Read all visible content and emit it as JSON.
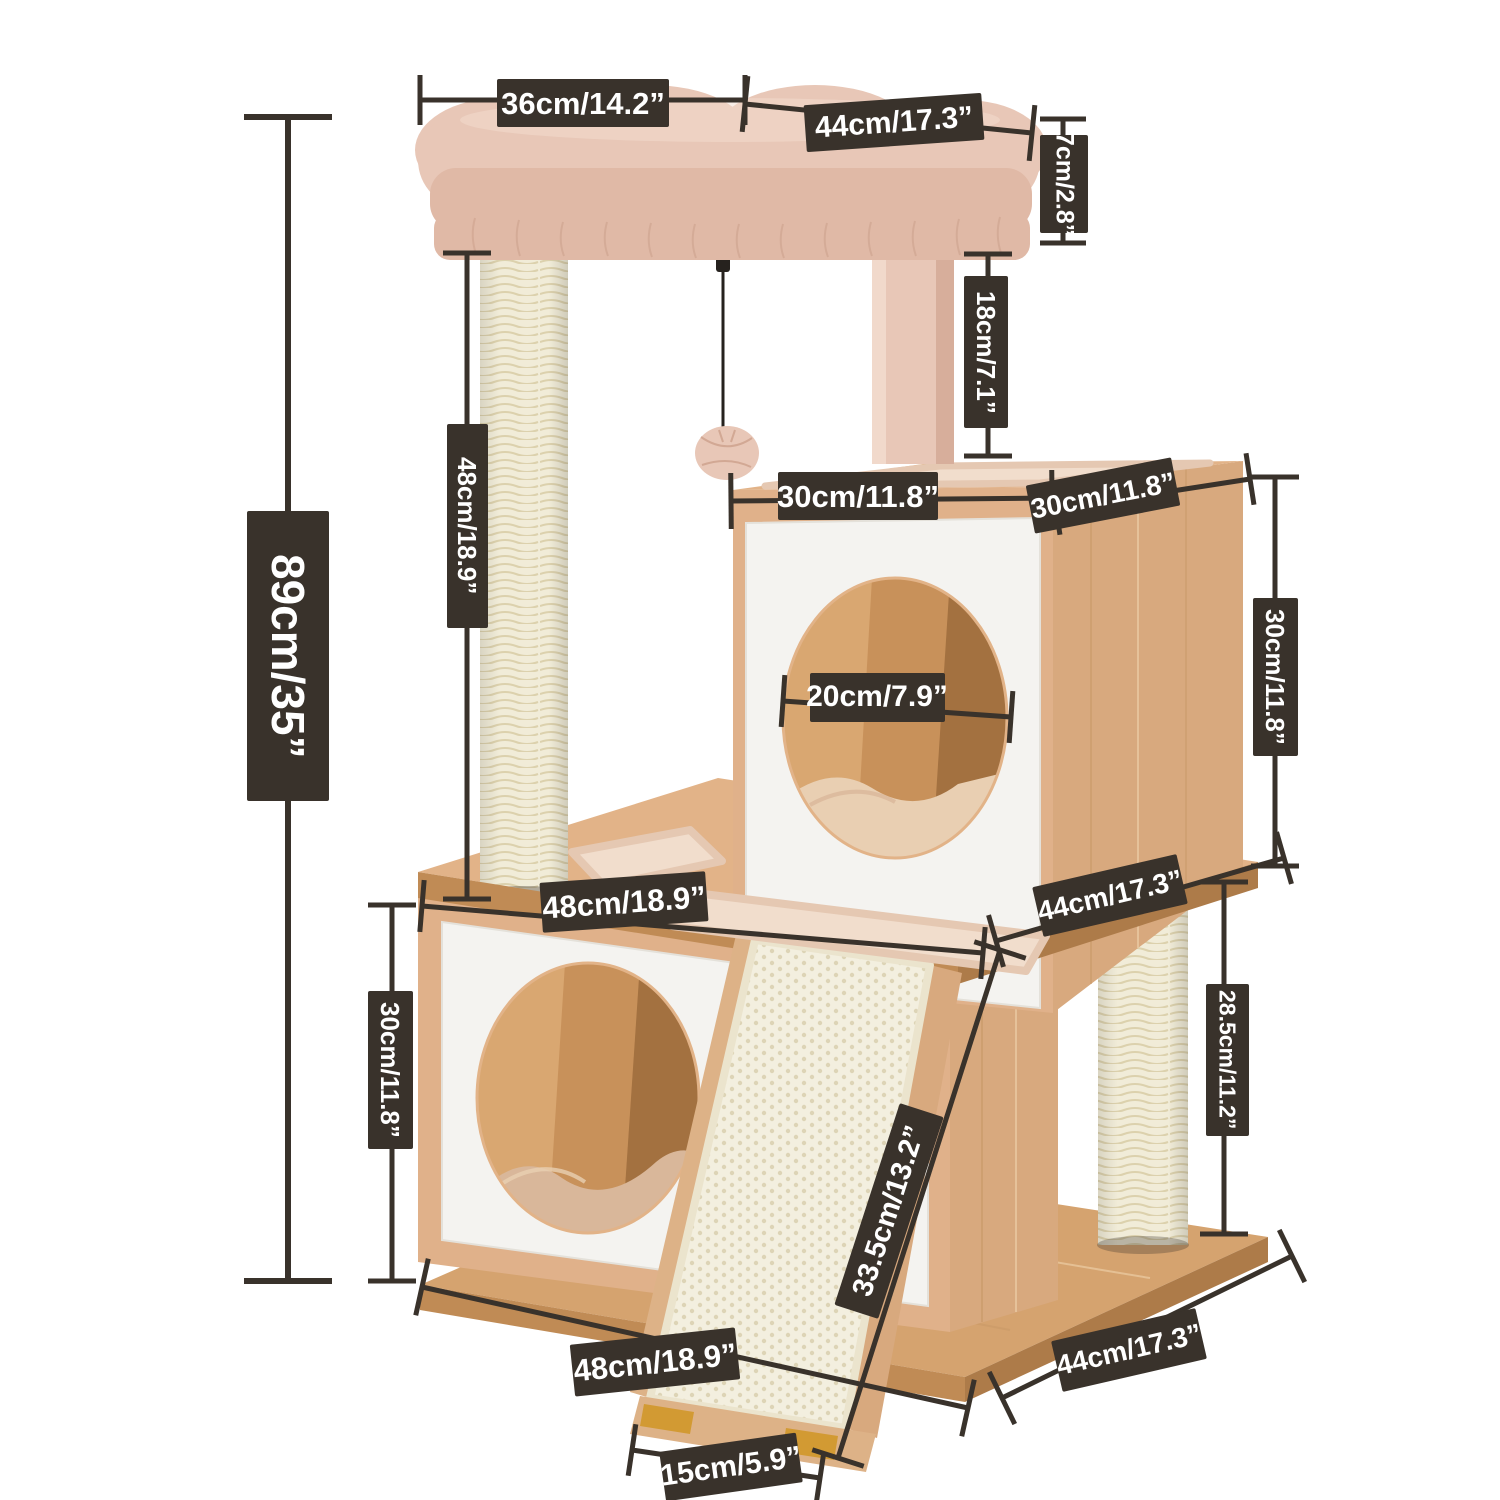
{
  "figure": {
    "background": "#ffffff",
    "kind": "product-dimension-diagram",
    "subject": "cat tree tower with two cube houses, top plush bed, scratching posts and sisal ramp"
  },
  "colors": {
    "bg": "#ffffff",
    "label_bg": "#39322b",
    "label_text": "#ffffff",
    "dim_line": "#39322b",
    "wood_top": "#e2b388",
    "wood_front": "#e0b18a",
    "wood_side": "#d8a97e",
    "wood_grain_dark": "#c69663",
    "wood_grain_light": "#f0d3ad",
    "wood_edge_dark": "#c08b55",
    "wood_edge_darker": "#ad7b49",
    "base_top": "#d5a36f",
    "panel": "#f4f3f0",
    "panel_edge": "#e4e1da",
    "sisal": "#f1ecd8",
    "sisal_stripe": "#dcd1ad",
    "plush": "#e8c7b7",
    "plush_dark": "#e0b9a6",
    "plush_deep": "#d2a894",
    "plush_light": "#f3ddcf",
    "mat": "#f1ddcc",
    "mat_edge": "#e5c8b2",
    "hole_wood": "#c8915a",
    "hole_wood_light": "#d9a771",
    "hole_wood_dark": "#a37140",
    "cushion": "#e9cfb2",
    "cushion_dark": "#d9b79a",
    "ramp_wood": "#ddb287",
    "ramp_sisal": "#f3efdf",
    "ramp_dot": "#ddd4b6",
    "ramp_edge": "#ebe4cd",
    "foot": "#d29a33",
    "string": "#26221e"
  },
  "dimension_labels": [
    {
      "id": "bed-front-width",
      "text": "36cm/14.2”",
      "x": 583,
      "y": 103,
      "w": 172,
      "h": 48,
      "rot": 0,
      "mode": "h",
      "fs": 31
    },
    {
      "id": "bed-side-depth",
      "text": "44cm/17.3”",
      "x": 894,
      "y": 122,
      "w": 178,
      "h": 47,
      "rot": -4,
      "mode": "h",
      "fs": 30
    },
    {
      "id": "bed-thickness",
      "text": "7cm/2.8”",
      "x": 1064,
      "y": 184,
      "w": 48,
      "h": 98,
      "rot": 0,
      "mode": "v",
      "fs": 25
    },
    {
      "id": "bed-to-cube-gap",
      "text": "18cm/7.1”",
      "x": 986,
      "y": 352,
      "w": 44,
      "h": 152,
      "rot": 0,
      "mode": "v",
      "fs": 26
    },
    {
      "id": "total-height",
      "text": "89cm/35”",
      "x": 288,
      "y": 656,
      "w": 82,
      "h": 290,
      "rot": 0,
      "mode": "v",
      "fs": 46
    },
    {
      "id": "top-post-height",
      "text": "48cm/18.9”",
      "x": 467,
      "y": 526,
      "w": 41,
      "h": 204,
      "rot": 0,
      "mode": "v",
      "fs": 26
    },
    {
      "id": "top-cube-width",
      "text": "30cm/11.8”",
      "x": 858,
      "y": 496,
      "w": 160,
      "h": 48,
      "rot": 0,
      "mode": "h",
      "fs": 31
    },
    {
      "id": "top-cube-depth",
      "text": "30cm/11.8”",
      "x": 1103,
      "y": 495,
      "w": 148,
      "h": 49,
      "rot": -11,
      "mode": "h",
      "fs": 28
    },
    {
      "id": "top-cube-height",
      "text": "30cm/11.8”",
      "x": 1275,
      "y": 677,
      "w": 45,
      "h": 158,
      "rot": 0,
      "mode": "v",
      "fs": 26
    },
    {
      "id": "hole-diameter",
      "text": "20cm/7.9”",
      "x": 877,
      "y": 697,
      "w": 135,
      "h": 49,
      "rot": 0,
      "mode": "h",
      "fs": 30
    },
    {
      "id": "middle-platform-depth",
      "text": "44cm/17.3”",
      "x": 1110,
      "y": 895,
      "w": 148,
      "h": 51,
      "rot": -13,
      "mode": "h",
      "fs": 28
    },
    {
      "id": "middle-platform-width",
      "text": "48cm/18.9”",
      "x": 624,
      "y": 902,
      "w": 166,
      "h": 50,
      "rot": -4,
      "mode": "h",
      "fs": 31
    },
    {
      "id": "bottom-cube-height",
      "text": "30cm/11.8”",
      "x": 390,
      "y": 1070,
      "w": 45,
      "h": 158,
      "rot": 0,
      "mode": "v",
      "fs": 26
    },
    {
      "id": "ramp-length",
      "text": "33.5cm/13.2”",
      "x": 889,
      "y": 1211,
      "w": 212,
      "h": 46,
      "rot": -72,
      "mode": "h",
      "fs": 29
    },
    {
      "id": "bottom-post-height",
      "text": "28.5cm/11.2”",
      "x": 1227,
      "y": 1060,
      "w": 43,
      "h": 152,
      "rot": 0,
      "mode": "v",
      "fs": 23
    },
    {
      "id": "base-width",
      "text": "48cm/18.9”",
      "x": 655,
      "y": 1362,
      "w": 166,
      "h": 52,
      "rot": -6,
      "mode": "h",
      "fs": 31
    },
    {
      "id": "base-depth",
      "text": "44cm/17.3”",
      "x": 1129,
      "y": 1350,
      "w": 148,
      "h": 52,
      "rot": -13,
      "mode": "h",
      "fs": 28
    },
    {
      "id": "ramp-foot-width",
      "text": "15cm/5.9”",
      "x": 731,
      "y": 1467,
      "w": 138,
      "h": 50,
      "rot": -8,
      "mode": "h",
      "fs": 30
    }
  ],
  "dimension_lines": [
    {
      "id": "bed-front-width",
      "x1": 420,
      "y1": 100,
      "x2": 745,
      "y2": 100,
      "t": 50
    },
    {
      "id": "bed-side-depth",
      "x1": 745,
      "y1": 104,
      "x2": 1032,
      "y2": 133,
      "t": 56
    },
    {
      "id": "bed-thickness",
      "x1": 1063,
      "y1": 119,
      "x2": 1063,
      "y2": 243,
      "t": 46
    },
    {
      "id": "bed-to-cube-gap",
      "x1": 988,
      "y1": 254,
      "x2": 988,
      "y2": 456,
      "t": 48
    },
    {
      "id": "total-height",
      "x1": 288,
      "y1": 117,
      "x2": 288,
      "y2": 1281,
      "t": 88,
      "w": 6
    },
    {
      "id": "top-post-height",
      "x1": 467,
      "y1": 253,
      "x2": 467,
      "y2": 899,
      "t": 48
    },
    {
      "id": "top-cube-width",
      "x1": 731,
      "y1": 501,
      "x2": 1052,
      "y2": 498,
      "t": 56
    },
    {
      "id": "top-cube-depth",
      "x1": 1056,
      "y1": 509,
      "x2": 1250,
      "y2": 479,
      "t": 52
    },
    {
      "id": "top-cube-height",
      "x1": 1275,
      "y1": 477,
      "x2": 1275,
      "y2": 866,
      "t": 48
    },
    {
      "id": "hole-diameter",
      "x1": 783,
      "y1": 701,
      "x2": 1011,
      "y2": 717,
      "t": 52
    },
    {
      "id": "middle-platform-depth",
      "x1": 996,
      "y1": 941,
      "x2": 1284,
      "y2": 858,
      "t": 54
    },
    {
      "id": "middle-platform-width",
      "x1": 422,
      "y1": 906,
      "x2": 983,
      "y2": 953,
      "t": 52
    },
    {
      "id": "bottom-cube-height",
      "x1": 392,
      "y1": 905,
      "x2": 392,
      "y2": 1281,
      "t": 48
    },
    {
      "id": "ramp-length",
      "x1": 1000,
      "y1": 950,
      "x2": 838,
      "y2": 1458,
      "t": 54
    },
    {
      "id": "bottom-post-height",
      "x1": 1224,
      "y1": 882,
      "x2": 1224,
      "y2": 1234,
      "t": 48
    },
    {
      "id": "base-width",
      "x1": 422,
      "y1": 1287,
      "x2": 968,
      "y2": 1408,
      "t": 58
    },
    {
      "id": "base-depth",
      "x1": 1002,
      "y1": 1398,
      "x2": 1292,
      "y2": 1256,
      "t": 58
    },
    {
      "id": "ramp-foot-width",
      "x1": 632,
      "y1": 1450,
      "x2": 820,
      "y2": 1478,
      "t": 52
    }
  ]
}
